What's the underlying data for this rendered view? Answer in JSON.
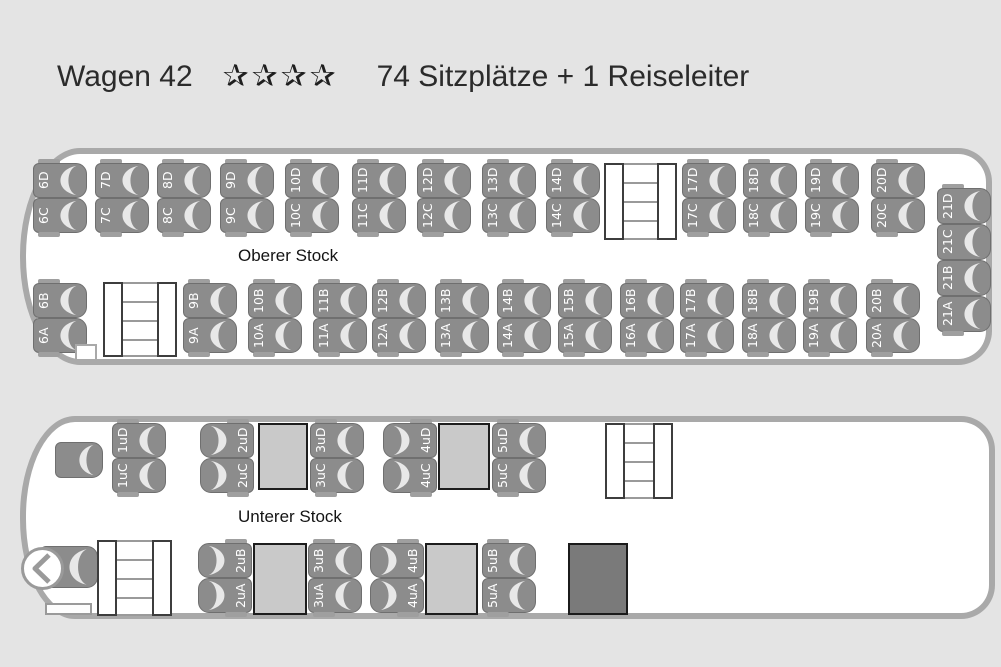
{
  "title": {
    "bus_name": "Wagen 42",
    "stars": "✰✰✰✰",
    "star_count": 4,
    "capacity": "74 Sitzplätze + 1 Reiseleiter"
  },
  "colors": {
    "background": "#e4e4e4",
    "bus_outline": "#a9a9a9",
    "seat": "#8c8c8c",
    "seat_cushion": "#e8e8e8",
    "table": "#c9c9c9",
    "wc_box": "#7a7a7a",
    "text": "#2b2b2b"
  },
  "decks": {
    "upper": {
      "label": "Oberer Stock",
      "pairs": [
        {
          "x": 7,
          "y": 9,
          "labels": [
            "6D",
            "6C"
          ]
        },
        {
          "x": 69,
          "y": 9,
          "labels": [
            "7D",
            "7C"
          ]
        },
        {
          "x": 131,
          "y": 9,
          "labels": [
            "8D",
            "8C"
          ]
        },
        {
          "x": 194,
          "y": 9,
          "labels": [
            "9D",
            "9C"
          ]
        },
        {
          "x": 259,
          "y": 9,
          "labels": [
            "10D",
            "10C"
          ]
        },
        {
          "x": 326,
          "y": 9,
          "labels": [
            "11D",
            "11C"
          ]
        },
        {
          "x": 391,
          "y": 9,
          "labels": [
            "12D",
            "12C"
          ]
        },
        {
          "x": 456,
          "y": 9,
          "labels": [
            "13D",
            "13C"
          ]
        },
        {
          "x": 520,
          "y": 9,
          "labels": [
            "14D",
            "14C"
          ]
        },
        {
          "x": 656,
          "y": 9,
          "labels": [
            "17D",
            "17C"
          ]
        },
        {
          "x": 717,
          "y": 9,
          "labels": [
            "18D",
            "18C"
          ]
        },
        {
          "x": 779,
          "y": 9,
          "labels": [
            "19D",
            "19C"
          ]
        },
        {
          "x": 845,
          "y": 9,
          "labels": [
            "20D",
            "20C"
          ]
        },
        {
          "x": 7,
          "y": 129,
          "labels": [
            "6B",
            "6A"
          ]
        },
        {
          "x": 157,
          "y": 129,
          "labels": [
            "9B",
            "9A"
          ]
        },
        {
          "x": 222,
          "y": 129,
          "labels": [
            "10B",
            "10A"
          ]
        },
        {
          "x": 287,
          "y": 129,
          "labels": [
            "11B",
            "11A"
          ]
        },
        {
          "x": 346,
          "y": 129,
          "labels": [
            "12B",
            "12A"
          ]
        },
        {
          "x": 409,
          "y": 129,
          "labels": [
            "13B",
            "13A"
          ]
        },
        {
          "x": 471,
          "y": 129,
          "labels": [
            "14B",
            "14A"
          ]
        },
        {
          "x": 532,
          "y": 129,
          "labels": [
            "15B",
            "15A"
          ]
        },
        {
          "x": 594,
          "y": 129,
          "labels": [
            "16B",
            "16A"
          ]
        },
        {
          "x": 654,
          "y": 129,
          "labels": [
            "17B",
            "17A"
          ]
        },
        {
          "x": 716,
          "y": 129,
          "labels": [
            "18B",
            "18A"
          ]
        },
        {
          "x": 777,
          "y": 129,
          "labels": [
            "19B",
            "19A"
          ]
        },
        {
          "x": 840,
          "y": 129,
          "labels": [
            "20B",
            "20A"
          ]
        },
        {
          "x": 911,
          "y": 34,
          "seat_h": 36,
          "labels": [
            "21D",
            "21C",
            "21B",
            "21A"
          ]
        }
      ],
      "features": [
        {
          "type": "stairs",
          "name": "staircase-rear",
          "x": 578,
          "y": 9,
          "w": 73,
          "h": 77
        },
        {
          "type": "stairs",
          "name": "staircase-front",
          "x": 77,
          "y": 128,
          "w": 74,
          "h": 75
        },
        {
          "type": "notch",
          "name": "front-notch",
          "x": 49,
          "y": 190,
          "w": 22,
          "h": 15
        }
      ]
    },
    "lower": {
      "label": "Unterer Stock",
      "pairs": [
        {
          "x": 86,
          "y": 1,
          "labels": [
            "1uD",
            "1uC"
          ]
        },
        {
          "x": 174,
          "y": 1,
          "mirrored": true,
          "labels": [
            "2uD",
            "2uC"
          ]
        },
        {
          "x": 284,
          "y": 1,
          "labels": [
            "3uD",
            "3uC"
          ]
        },
        {
          "x": 357,
          "y": 1,
          "mirrored": true,
          "labels": [
            "4uD",
            "4uC"
          ]
        },
        {
          "x": 466,
          "y": 1,
          "labels": [
            "5uD",
            "5uC"
          ]
        },
        {
          "x": 172,
          "y": 121,
          "mirrored": true,
          "labels": [
            "2uB",
            "2uA"
          ]
        },
        {
          "x": 282,
          "y": 121,
          "labels": [
            "3uB",
            "3uA"
          ]
        },
        {
          "x": 344,
          "y": 121,
          "mirrored": true,
          "labels": [
            "4uB",
            "4uA"
          ]
        },
        {
          "x": 456,
          "y": 121,
          "labels": [
            "5uB",
            "5uA"
          ]
        }
      ],
      "features": [
        {
          "type": "seat-single",
          "name": "tour-guide-seat",
          "interactable": "true",
          "x": 29,
          "y": 20,
          "w": 48,
          "h": 36
        },
        {
          "type": "table",
          "name": "table",
          "x": 232,
          "y": 1,
          "w": 50,
          "h": 67
        },
        {
          "type": "table",
          "name": "table",
          "x": 412,
          "y": 1,
          "w": 52,
          "h": 67
        },
        {
          "type": "stairs",
          "name": "staircase-rear",
          "x": 579,
          "y": 1,
          "w": 68,
          "h": 76
        },
        {
          "type": "seat-single",
          "name": "driver-seat",
          "interactable": "false",
          "x": 14,
          "y": 124,
          "w": 58,
          "h": 42
        },
        {
          "type": "steering",
          "name": "steering-wheel-icon",
          "x": -6,
          "y": 124,
          "w": 45,
          "h": 45
        },
        {
          "type": "dash",
          "name": "dashboard",
          "x": 19,
          "y": 181,
          "w": 47,
          "h": 12
        },
        {
          "type": "stairs",
          "name": "staircase-front",
          "x": 71,
          "y": 118,
          "w": 75,
          "h": 76
        },
        {
          "type": "table",
          "name": "table",
          "x": 227,
          "y": 121,
          "w": 54,
          "h": 72
        },
        {
          "type": "table",
          "name": "table",
          "x": 399,
          "y": 121,
          "w": 53,
          "h": 72
        },
        {
          "type": "wc",
          "name": "wc-compartment",
          "x": 542,
          "y": 121,
          "w": 60,
          "h": 72
        }
      ]
    }
  }
}
